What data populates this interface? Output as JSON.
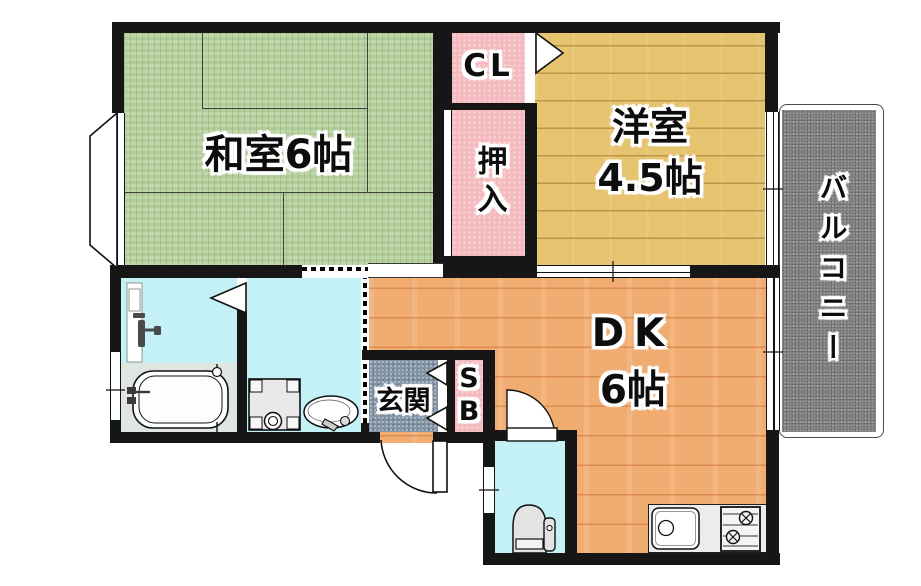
{
  "plan_type": "apartment-floor-plan",
  "rooms": {
    "washitsu": {
      "label": "和室6帖"
    },
    "yoshitsu": {
      "line1": "洋室",
      "line2": "4.5帖"
    },
    "closet": {
      "label": "CL"
    },
    "oshiire": {
      "label": "押入"
    },
    "balcony": {
      "label": "バルコニー"
    },
    "dk": {
      "line1": "DK",
      "line2": "6帖"
    },
    "genkan": {
      "label": "玄関"
    },
    "shoebox": {
      "label": "SB"
    }
  },
  "colors": {
    "tatami": "#b9d3a1",
    "wood-light": "#e5c36f",
    "wood-orange": "#f0ac71",
    "pink": "#f4babe",
    "cyan": "#c4f1f6",
    "genkan-gray": "#8296a8",
    "balcony-gray": "#8d8d8d",
    "bath-floor": "#dfe6e1",
    "counter-gray": "#ececec",
    "wall": "#161616"
  },
  "fixtures": [
    "bathtub",
    "shower-mixer",
    "washing-machine-pan",
    "washbasin",
    "toilet",
    "kitchen-sink",
    "gas-stove",
    "entrance-door",
    "toilet-door"
  ]
}
